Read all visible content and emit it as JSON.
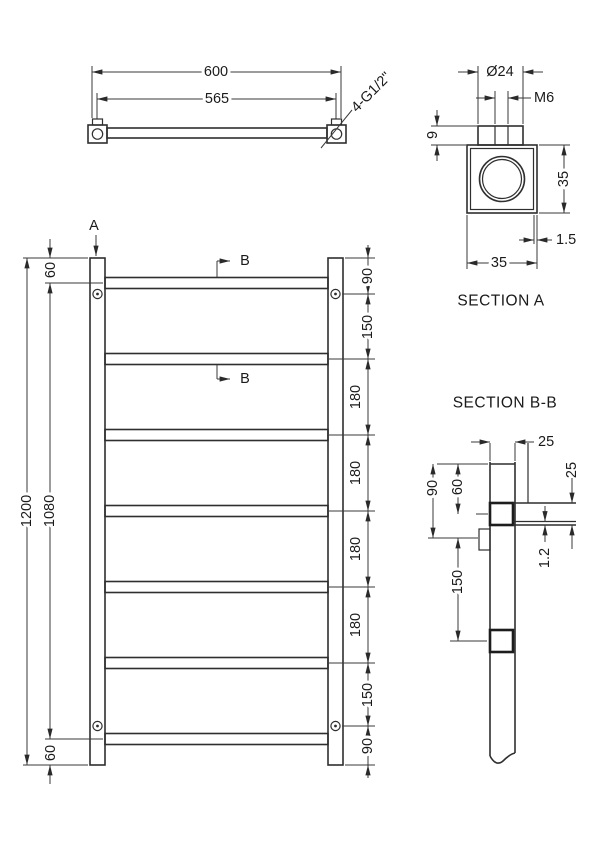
{
  "colors": {
    "background": "#ffffff",
    "line_object": "#2f2f2f",
    "line_dimension": "#3a3a3a",
    "text": "#1a1a1a"
  },
  "top_view": {
    "dim_overall_width": "600",
    "dim_connection_centres": "565",
    "thread_callout": "4-G1/2\""
  },
  "section_a": {
    "title": "SECTION A",
    "dim_boss_diameter": "Ø24",
    "dim_thread": "M6",
    "dim_boss_height": "9",
    "dim_block_height": "35",
    "dim_block_width": "35",
    "dim_wall_thickness": "1.5"
  },
  "front_view": {
    "section_arrow_a": "A",
    "section_arrow_b_top": "B",
    "section_arrow_b_bottom": "B",
    "dim_top_offset": "60",
    "dim_overall_height": "1200",
    "dim_bracket_centres": "1080",
    "dim_bottom_offset": "60",
    "right_chain": [
      "90",
      "150",
      "180",
      "180",
      "180",
      "180",
      "150",
      "90"
    ]
  },
  "section_bb": {
    "title": "SECTION B-B",
    "dim_post_width": "25",
    "dim_rung_size": "25",
    "dim_top_to_rung": "60",
    "dim_top_to_bracket": "90",
    "dim_bracket_to_rung": "150",
    "dim_wall_thickness": "1.2"
  }
}
